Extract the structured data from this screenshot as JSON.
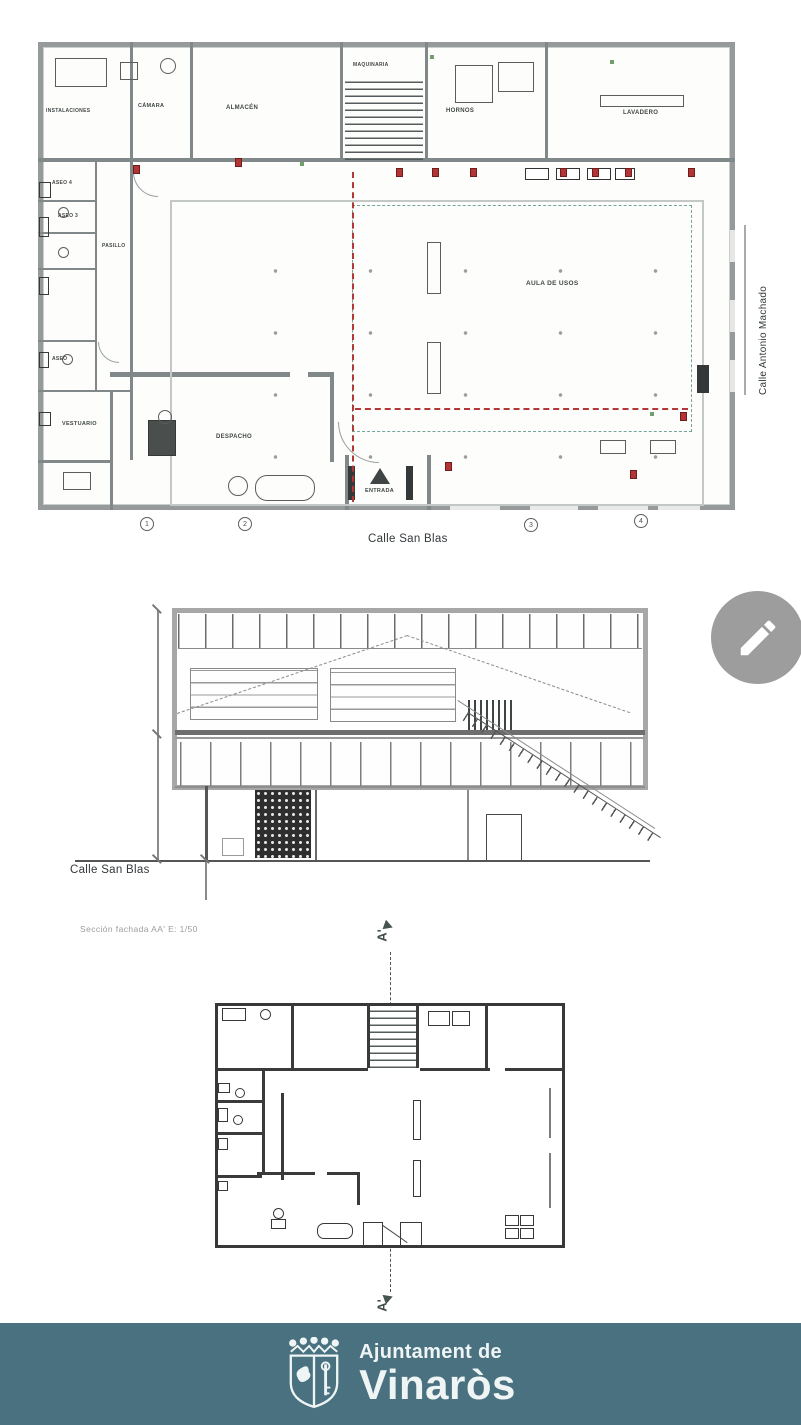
{
  "top_plan": {
    "street_bottom": "Calle San Blas",
    "street_right": "Calle Antonio Machado",
    "rooms": {
      "instalaciones": "INSTALACIONES",
      "camara": "CÁMARA",
      "almacen": "ALMACÉN",
      "maquinaria": "MAQUINARIA",
      "hornos": "HORNOS",
      "lavadero": "LAVADERO",
      "aseo4": "ASEO 4",
      "aseo3": "ASEO 3",
      "pasillo": "PASILLO",
      "aseo": "ASEO",
      "vestuario": "VESTUARIO",
      "despacho": "DESPACHO",
      "aula": "AULA DE USOS",
      "entrada": "ENTRADA"
    },
    "grid_markers": [
      "1",
      "2",
      "3",
      "4"
    ]
  },
  "section": {
    "street_label": "Calle San Blas",
    "caption": "Sección fachada AA'   E: 1/50"
  },
  "section_line": {
    "top_label": "A'",
    "bottom_label": "A'"
  },
  "footer": {
    "line1": "Ajuntament de",
    "line2": "Vinaròs"
  },
  "colors": {
    "footer_bg": "#4a7180",
    "footer_fg": "#eef5f4",
    "wall_gray": "#80888a",
    "accent_red": "#b23434",
    "accent_teal_dash": "#74a49b",
    "fab_bg": "#9d9d9d"
  }
}
